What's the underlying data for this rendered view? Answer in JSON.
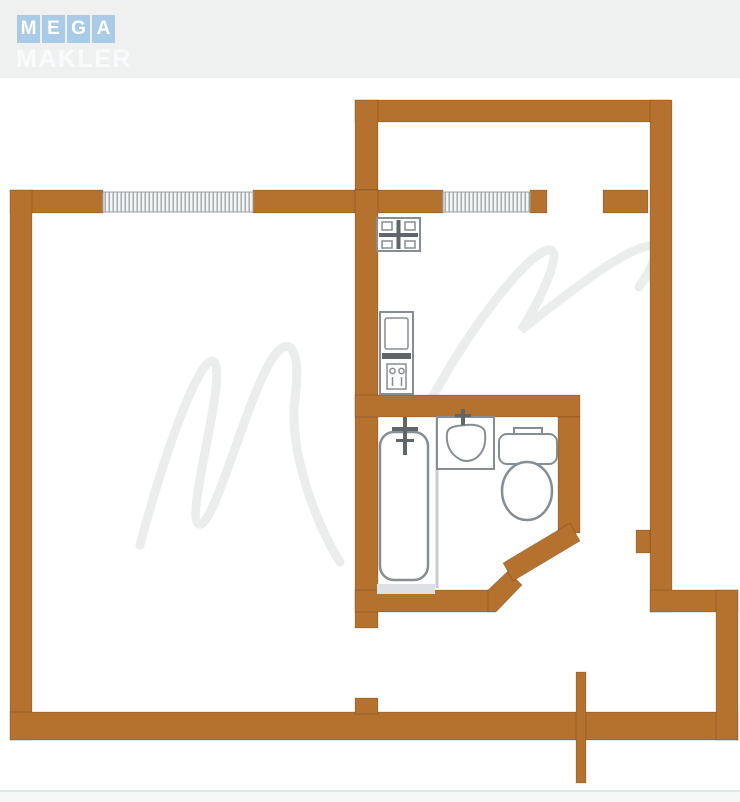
{
  "header": {
    "logo_letters": [
      "M",
      "E",
      "G",
      "A"
    ],
    "logo_word": "MAKLER"
  },
  "colors": {
    "planBg": "#ffffff",
    "headerBg": "#eff1f1",
    "logoBlue": "#a9cbe6",
    "logoText": "#ffffff",
    "maklerText": "#f9fafb",
    "wall": "#b5722f",
    "fixture": "#878e93",
    "fixtureDark": "#5f6569",
    "hatchBg": "#f4f5f5",
    "hatchLine": "#9aa0a4",
    "tubShade": "#dce1e3",
    "watermark": "#ebecec",
    "divider": "#e3e6e6"
  },
  "floorplan": {
    "type": "apartment-floor-plan",
    "fixtures": [
      "stove",
      "kitchen-sink",
      "bathtub",
      "washbasin",
      "toilet"
    ],
    "windows": [
      "living-room-window",
      "kitchen-window"
    ],
    "openings": [
      "balcony-door",
      "living-room-door",
      "bathroom-door",
      "entrance-door"
    ],
    "areas": [
      "balcony",
      "living-room",
      "kitchen",
      "bathroom",
      "hallway"
    ]
  }
}
